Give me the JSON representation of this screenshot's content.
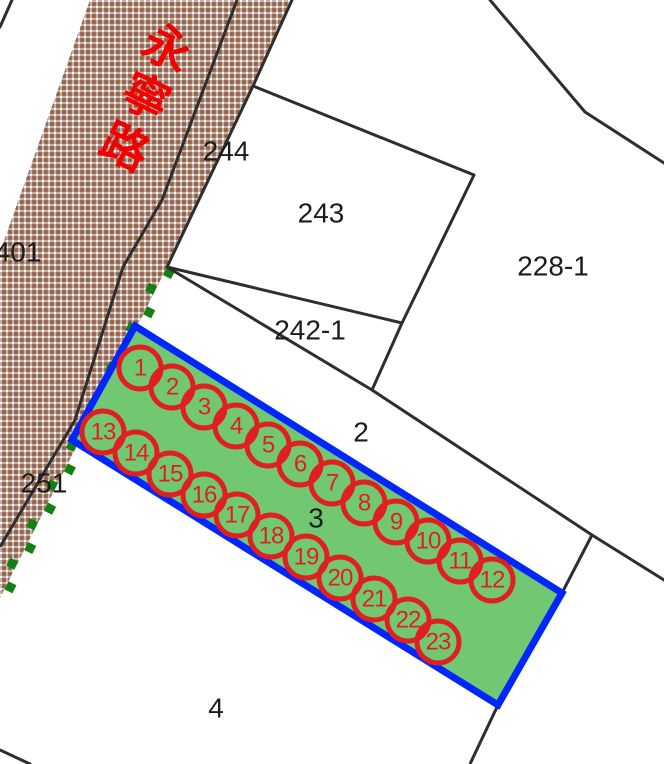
{
  "map": {
    "road_label": {
      "text": "永寧路",
      "chars": [
        {
          "ch": "永",
          "x": 167,
          "y": 48
        },
        {
          "ch": "寧",
          "x": 146,
          "y": 97
        },
        {
          "ch": "路",
          "x": 125,
          "y": 147
        }
      ],
      "rotation_deg": 26
    },
    "parcel_labels": [
      {
        "text": "401",
        "x": 18,
        "y": 252
      },
      {
        "text": "244",
        "x": 226,
        "y": 151
      },
      {
        "text": "243",
        "x": 321,
        "y": 213
      },
      {
        "text": "228-1",
        "x": 553,
        "y": 266
      },
      {
        "text": "242-1",
        "x": 310,
        "y": 330
      },
      {
        "text": "2",
        "x": 361,
        "y": 432
      },
      {
        "text": "3",
        "x": 316,
        "y": 518
      },
      {
        "text": "251",
        "x": 44,
        "y": 483
      },
      {
        "text": "4",
        "x": 216,
        "y": 708
      }
    ],
    "markers": [
      {
        "n": "1",
        "x": 140,
        "y": 368
      },
      {
        "n": "2",
        "x": 172,
        "y": 387
      },
      {
        "n": "3",
        "x": 204,
        "y": 407
      },
      {
        "n": "4",
        "x": 236,
        "y": 426
      },
      {
        "n": "5",
        "x": 268,
        "y": 445
      },
      {
        "n": "6",
        "x": 300,
        "y": 464
      },
      {
        "n": "7",
        "x": 332,
        "y": 483
      },
      {
        "n": "8",
        "x": 364,
        "y": 503
      },
      {
        "n": "9",
        "x": 396,
        "y": 522
      },
      {
        "n": "10",
        "x": 428,
        "y": 541
      },
      {
        "n": "11",
        "x": 460,
        "y": 561
      },
      {
        "n": "12",
        "x": 492,
        "y": 580
      },
      {
        "n": "13",
        "x": 103,
        "y": 432
      },
      {
        "n": "14",
        "x": 136,
        "y": 453
      },
      {
        "n": "15",
        "x": 170,
        "y": 474
      },
      {
        "n": "16",
        "x": 204,
        "y": 495
      },
      {
        "n": "17",
        "x": 237,
        "y": 515
      },
      {
        "n": "18",
        "x": 271,
        "y": 536
      },
      {
        "n": "19",
        "x": 306,
        "y": 557
      },
      {
        "n": "20",
        "x": 340,
        "y": 578
      },
      {
        "n": "21",
        "x": 374,
        "y": 599
      },
      {
        "n": "22",
        "x": 408,
        "y": 620
      },
      {
        "n": "23",
        "x": 438,
        "y": 642
      }
    ],
    "marker_radius": 21,
    "colors": {
      "road_text": "#f40000",
      "marker_ring": "#e02020",
      "marker_text": "#e02020",
      "boundary": "#2e2e2e",
      "parcel_fill": "#72c872",
      "parcel_border": "#0026ff",
      "dash_green": "#138013",
      "label_text": "#1c1c1c",
      "road_base": "#a1715a",
      "road_lane": "#c4b2a8"
    }
  }
}
